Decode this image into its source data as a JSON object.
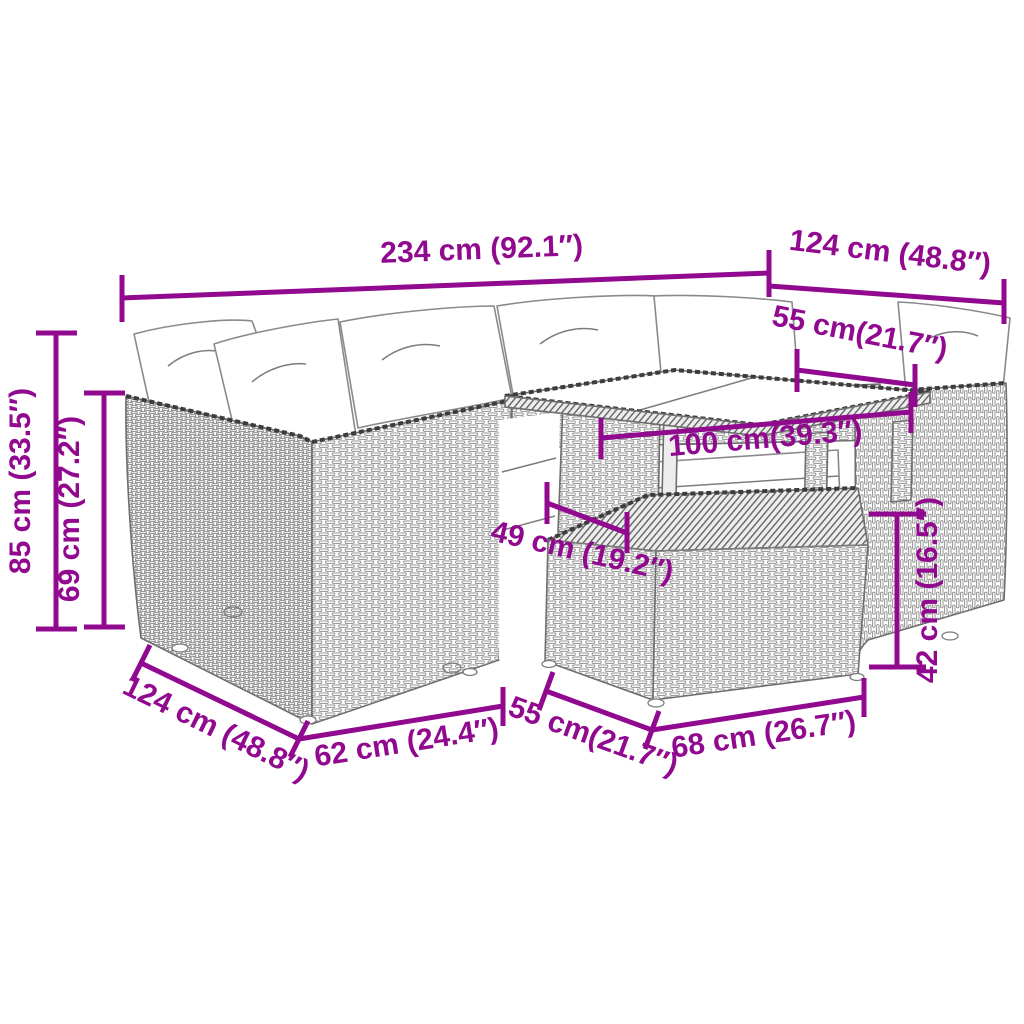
{
  "colors": {
    "accent": "#91098f",
    "line_art": "#7c7c7c",
    "rim": "#3c3c3c",
    "background": "#ffffff"
  },
  "dimensions": {
    "total_width": {
      "label": "234 cm (92.1″)"
    },
    "right_depth": {
      "label": "124 cm (48.8″)"
    },
    "seat_width": {
      "label": "55 cm(21.7″)"
    },
    "table_length": {
      "label": "100 cm(39.3″)"
    },
    "table_depth": {
      "label": "49 cm (19.2″)"
    },
    "total_height": {
      "label": "85 cm (33.5″)"
    },
    "back_height": {
      "label": "69 cm (27.2″)"
    },
    "ottoman_height": {
      "label": "42 cm (16.5″)"
    },
    "left_depth": {
      "label": "124 cm (48.8″)"
    },
    "module_width": {
      "label": "62 cm (24.4″)"
    },
    "ottoman_depth": {
      "label": "55 cm(21.7″)"
    },
    "ottoman_width": {
      "label": "68 cm (26.7″)"
    }
  }
}
